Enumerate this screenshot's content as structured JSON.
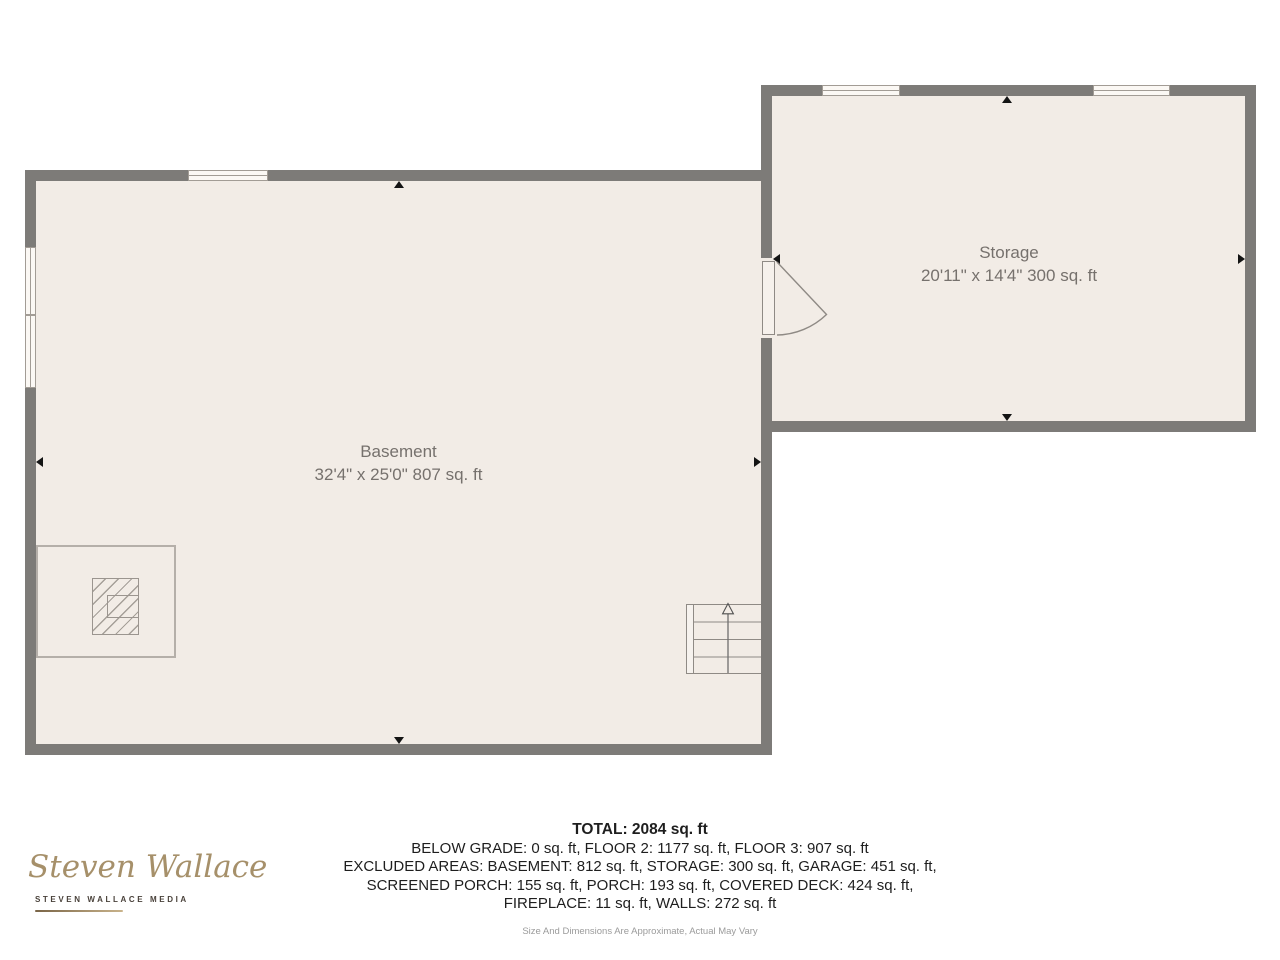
{
  "floorplan": {
    "rooms": [
      {
        "name": "Basement",
        "dimensions": "32'4\" x 25'0\" 807 sq. ft"
      },
      {
        "name": "Storage",
        "dimensions": "20'11\" x 14'4\" 300 sq. ft"
      }
    ],
    "features": [
      "window",
      "door-swing",
      "staircase",
      "fireplace",
      "wall-midpoint-arrow"
    ]
  },
  "summary": {
    "total": "TOTAL: 2084 sq. ft",
    "lines": [
      "BELOW GRADE: 0 sq. ft, FLOOR 2: 1177 sq. ft, FLOOR 3: 907 sq. ft",
      "EXCLUDED AREAS: BASEMENT: 812 sq. ft, STORAGE: 300 sq. ft, GARAGE: 451 sq. ft,",
      "SCREENED PORCH: 155 sq. ft, PORCH: 193 sq. ft, COVERED DECK: 424 sq. ft,",
      "FIREPLACE: 11 sq. ft, WALLS: 272 sq. ft"
    ],
    "disclaimer": "Size And Dimensions Are Approximate, Actual May Vary"
  },
  "logo": {
    "script": "Steven Wallace",
    "subtext": "STEVEN WALLACE MEDIA"
  },
  "colors": {
    "wall": "#7d7b78",
    "floor": "#f2ece6",
    "page_background": "#ffffff",
    "room_label": "#76716d",
    "summary_text": "#1e1e1e",
    "disclaimer_text": "#9b9b9b",
    "logo_gold": "#a6906a",
    "arrow": "#141414"
  }
}
